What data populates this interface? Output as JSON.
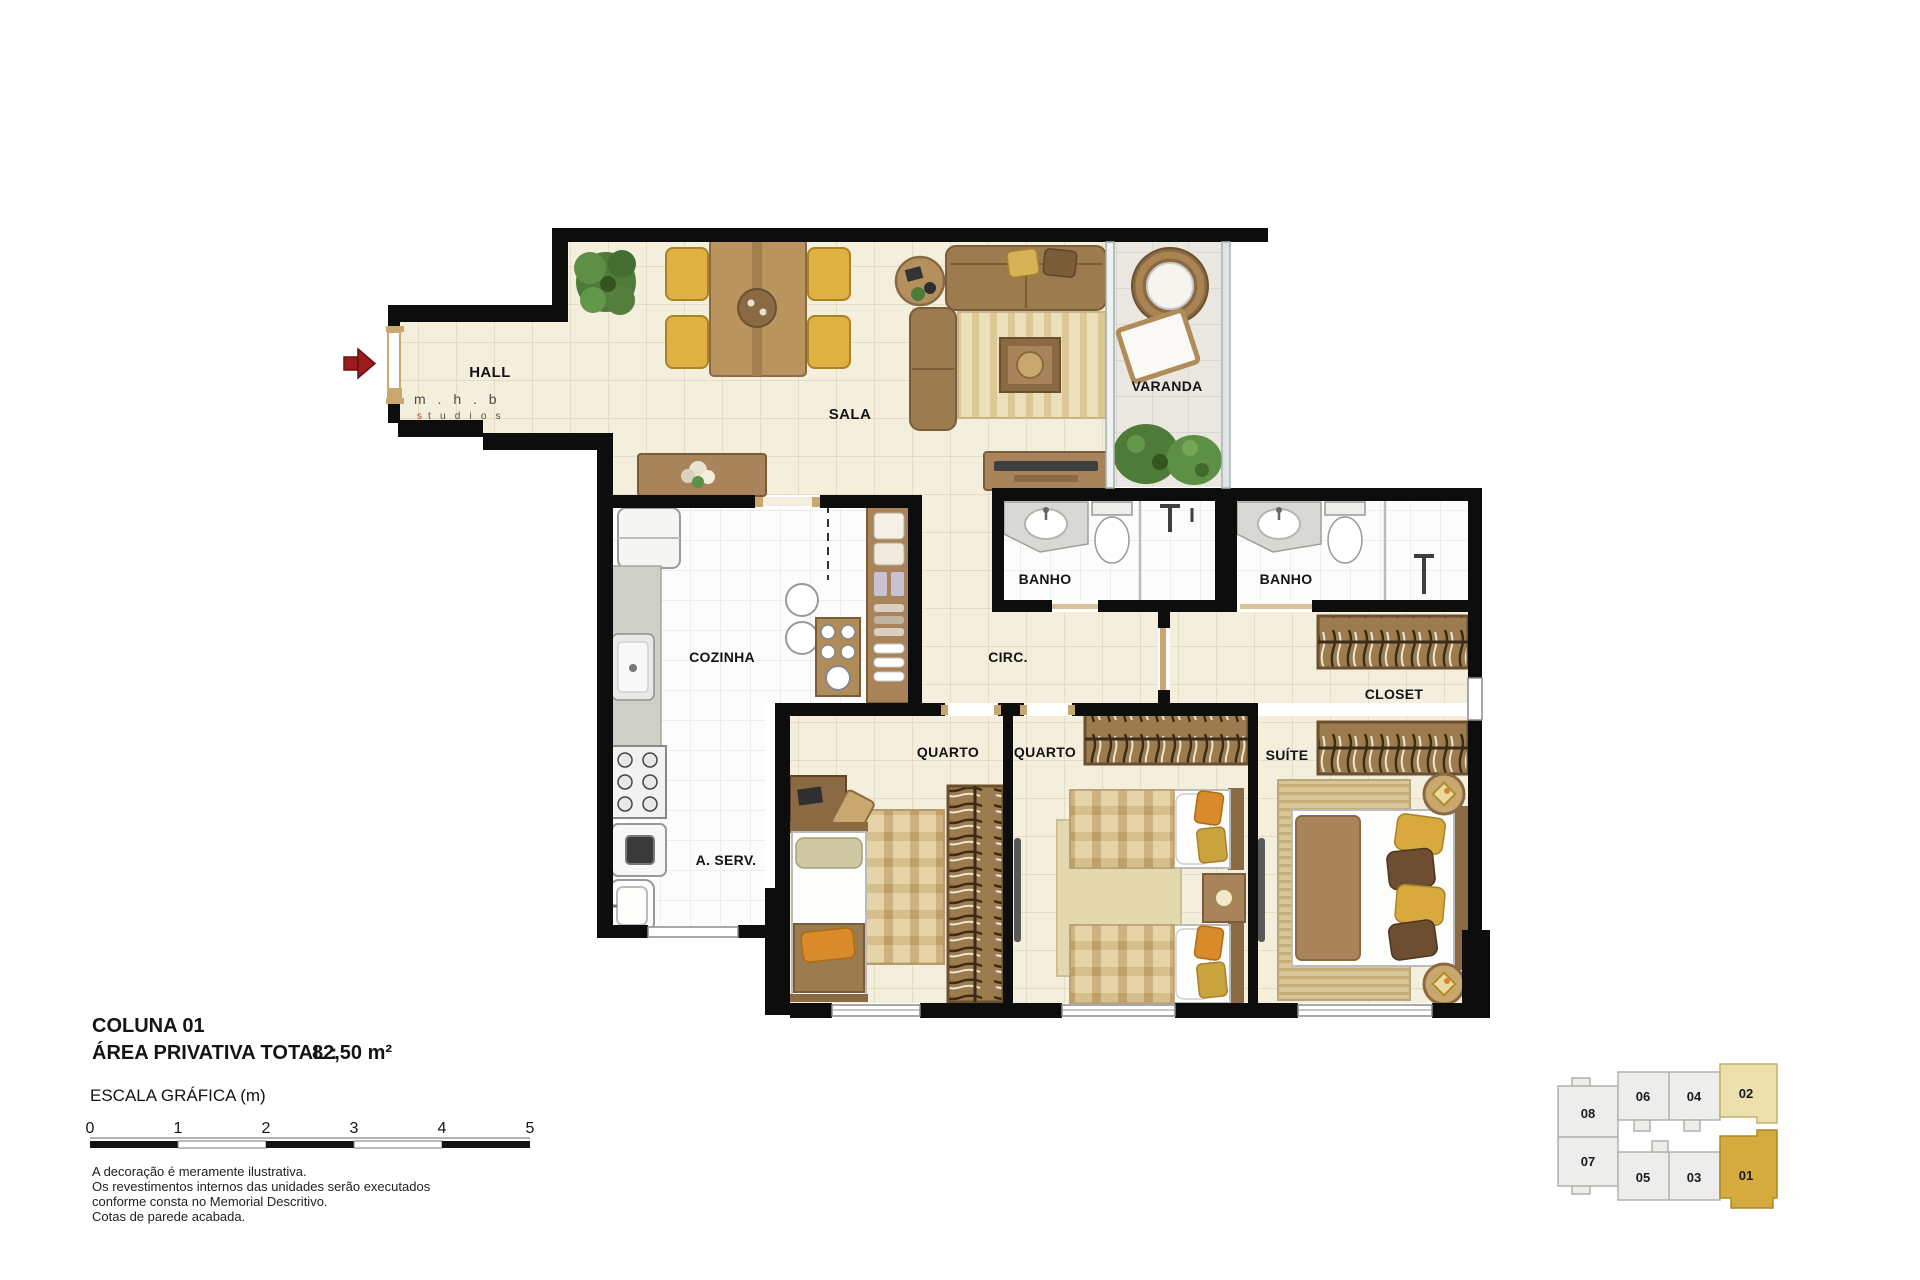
{
  "plan": {
    "rooms": {
      "hall": "HALL",
      "sala": "SALA",
      "varanda": "VARANDA",
      "banho_1": "BANHO",
      "banho_2": "BANHO",
      "cozinha": "COZINHA",
      "circ": "CIRC.",
      "a_serv": "A. SERV.",
      "quarto_1": "QUARTO",
      "quarto_2": "QUARTO",
      "suite": "SUÍTE",
      "closet": "CLOSET"
    },
    "logo": {
      "line1": "m . h . b",
      "line2_first": "s",
      "line2_rest": "t u d i o s"
    },
    "entrance_arrow_color": "#9b1c1c",
    "wall_color": "#0d0d0d",
    "floor_beige": "#f4eedd",
    "floor_white": "#fcfcfc",
    "floor_gray": "#e9e7e0"
  },
  "info": {
    "column_title": "COLUNA 01",
    "area_label": "ÁREA PRIVATIVA TOTAL :",
    "area_value": "82,50 m²",
    "scale_title": "ESCALA GRÁFICA (m)",
    "scale_ticks": [
      "0",
      "1",
      "2",
      "3",
      "4",
      "5"
    ],
    "disclaimer": [
      "A decoração é meramente ilustrativa.",
      "Os revestimentos internos das unidades serão executados",
      "conforme consta no Memorial Descritivo.",
      "Cotas de parede acabada."
    ]
  },
  "keyplan": {
    "units": [
      {
        "id": "08",
        "highlight": "none"
      },
      {
        "id": "06",
        "highlight": "none"
      },
      {
        "id": "04",
        "highlight": "none"
      },
      {
        "id": "02",
        "highlight": "light"
      },
      {
        "id": "07",
        "highlight": "none"
      },
      {
        "id": "05",
        "highlight": "none"
      },
      {
        "id": "03",
        "highlight": "none"
      },
      {
        "id": "01",
        "highlight": "strong"
      }
    ],
    "colors": {
      "default": "#ededeb",
      "light": "#ebdfab",
      "strong": "#d5ab40"
    }
  }
}
